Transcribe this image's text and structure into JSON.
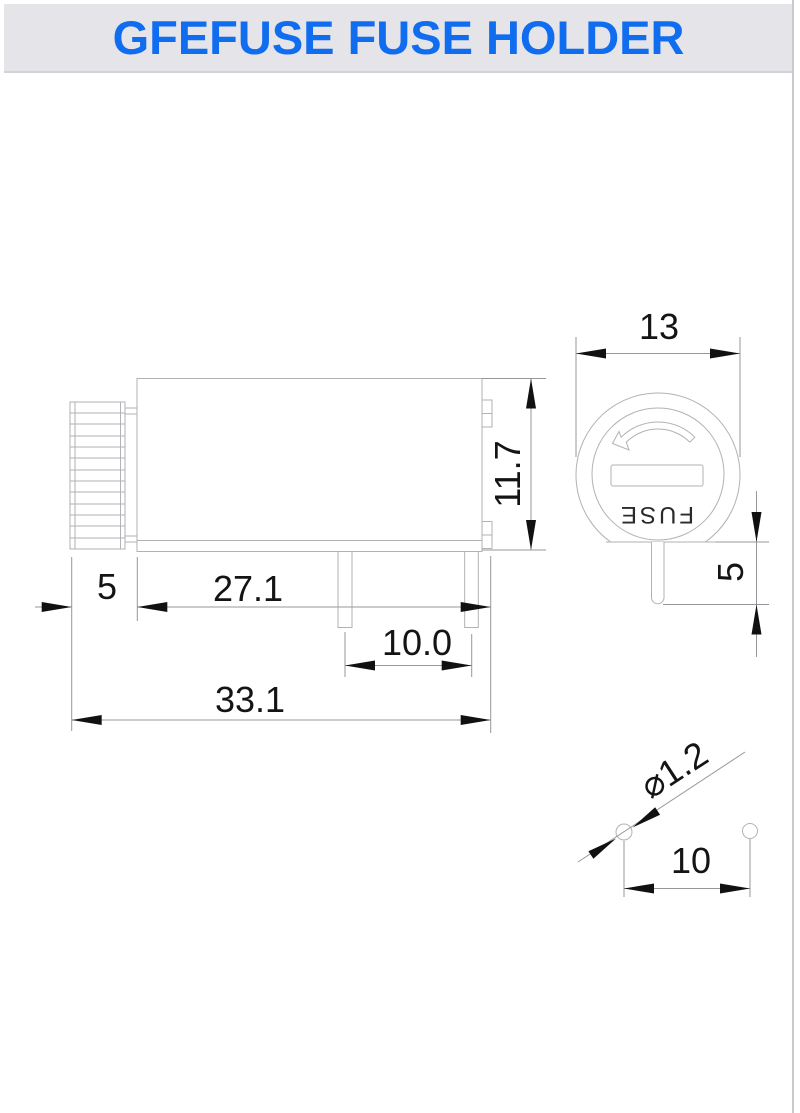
{
  "title": "GFEFUSE FUSE HOLDER",
  "colors": {
    "accent": "#116df0",
    "banner_bg": "#e4e4e9",
    "outline": "#b2b2b6",
    "dim_line": "#97979b",
    "dim_text": "#141414"
  },
  "front_view": {
    "fuse_label": "FUSE"
  },
  "dimensions": {
    "side_height": "11.7",
    "front_diameter": "13",
    "front_pin_length": "5",
    "cap_length": "5",
    "body_length": "27.1",
    "pin_spacing": "10.0",
    "overall_length": "33.1",
    "pin_diameter": "⌀1.2",
    "pin_pitch": "10"
  }
}
